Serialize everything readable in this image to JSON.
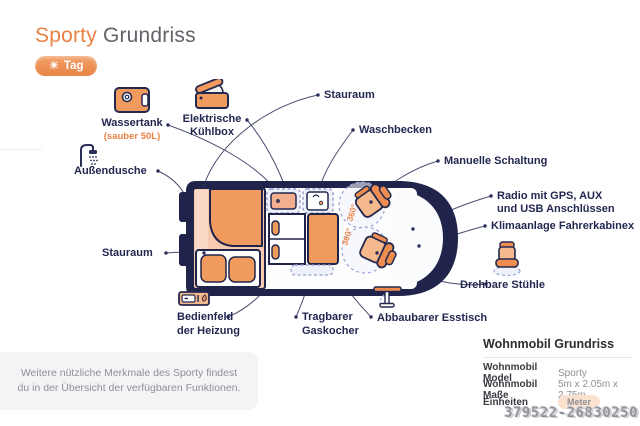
{
  "header": {
    "title_accent": "Sporty",
    "title_rest": " Grundriss",
    "mode_toggle": {
      "icon": "sun-icon",
      "glyph": "☀",
      "label": "Tag"
    }
  },
  "diagram": {
    "rotation_labels": [
      "360°",
      "360°"
    ],
    "callouts": {
      "wassertank": {
        "icon": "water-tank-icon",
        "title": "Wassertank",
        "note": "(sauber 50L)"
      },
      "kuehlbox": {
        "icon": "coolbox-icon",
        "lines": [
          "Elektrische",
          "Kühlbox"
        ]
      },
      "stauraum_top": {
        "label": "Stauraum"
      },
      "waschbecken": {
        "label": "Waschbecken"
      },
      "manuelle_schaltung": {
        "label": "Manuelle Schaltung"
      },
      "radio": {
        "lines": [
          "Radio mit GPS, AUX",
          "und USB Anschlüssen"
        ]
      },
      "klimaanlage": {
        "label": "Klimaanlage Fahrerkabinex"
      },
      "drehbare_stuehle": {
        "icon": "swivel-chair-icon",
        "label": "Drehbare Stühle"
      },
      "aussendusche": {
        "icon": "shower-icon",
        "label": "Außendusche"
      },
      "stauraum_links": {
        "label": "Stauraum"
      },
      "bedienfeld": {
        "icon": "heater-panel-icon",
        "lines": [
          "Bedienfeld",
          "der Heizung"
        ]
      },
      "gaskocher": {
        "lines": [
          "Tragbarer",
          "Gaskocher"
        ]
      },
      "esstisch": {
        "icon": "table-icon",
        "label": "Abbaubarer Esstisch"
      }
    }
  },
  "footer_note": {
    "lines": [
      "Weitere nützliche Merkmale des Sporty findest",
      "du in der Übersicht der verfügbaren Funktionen."
    ]
  },
  "specs": {
    "heading": "Wohnmobil Grundriss",
    "rows": [
      {
        "label": "Wohnmobil Model",
        "value": "Sporty"
      },
      {
        "label": "Wohnmobil Maße",
        "value": "5m x 2.05m x 2.75m"
      },
      {
        "label": "Einheiten",
        "value": "Meter"
      }
    ],
    "watermark": "379522-26830250"
  },
  "colors": {
    "accent_orange": "#ED8A4D",
    "light_orange": "#F6B98D",
    "pale_orange": "#F7C9AE",
    "navy": "#23284E",
    "lavender_dash": "#9AA3D4",
    "muted_text": "#8F8F99",
    "badge_bg": "#FBE2CF"
  }
}
